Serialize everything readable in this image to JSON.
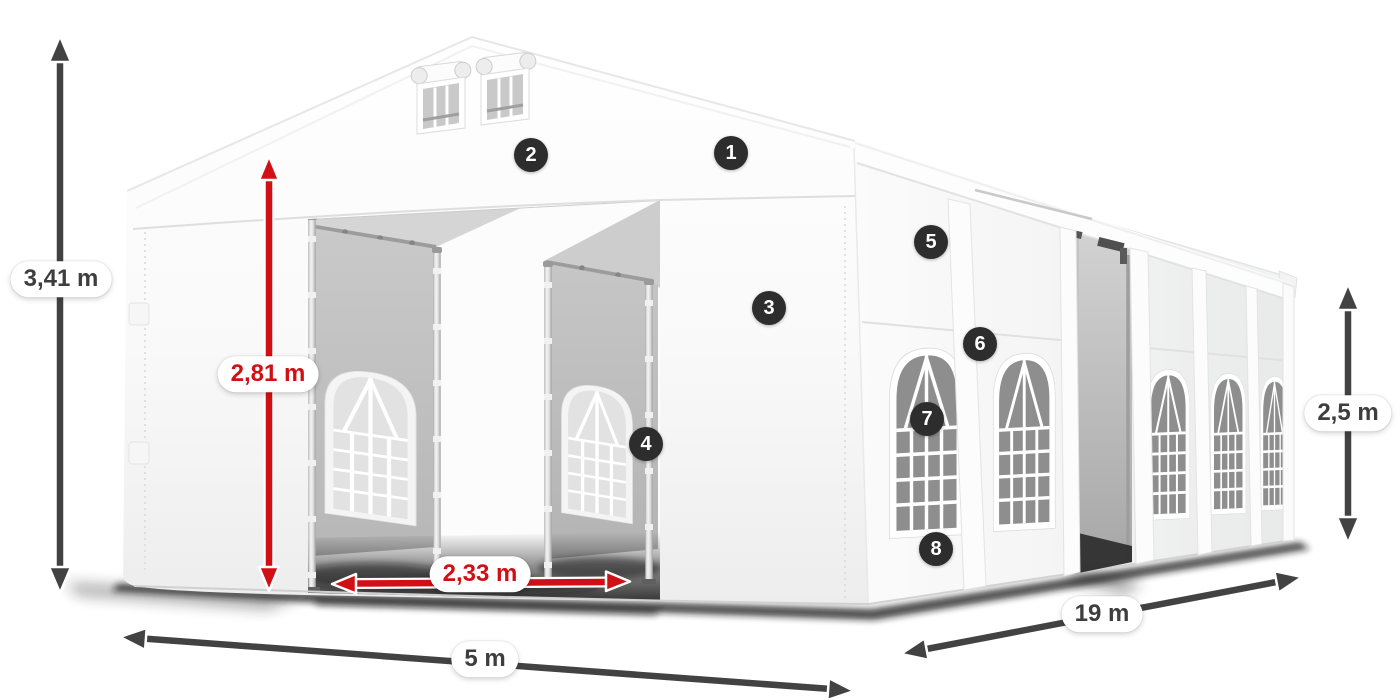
{
  "diagram": {
    "subject": "party-tent-dimensions",
    "view": "front-left-perspective"
  },
  "dimensions": {
    "total_height": {
      "value": "3,41 m",
      "accent": "gray"
    },
    "entrance_height": {
      "value": "2,81 m",
      "accent": "red"
    },
    "entrance_width": {
      "value": "2,33 m",
      "accent": "red"
    },
    "width": {
      "value": "5 m",
      "accent": "gray"
    },
    "length": {
      "value": "19 m",
      "accent": "gray"
    },
    "side_height": {
      "value": "2,5 m",
      "accent": "gray"
    }
  },
  "badges": [
    {
      "label": "1"
    },
    {
      "label": "2"
    },
    {
      "label": "3"
    },
    {
      "label": "4"
    },
    {
      "label": "5"
    },
    {
      "label": "6"
    },
    {
      "label": "7"
    },
    {
      "label": "8"
    }
  ],
  "colors": {
    "accent_red": "#d01014",
    "arrow_gray": "#424242",
    "badge_bg": "#2d2d2d",
    "tent_white": "#ffffff"
  }
}
